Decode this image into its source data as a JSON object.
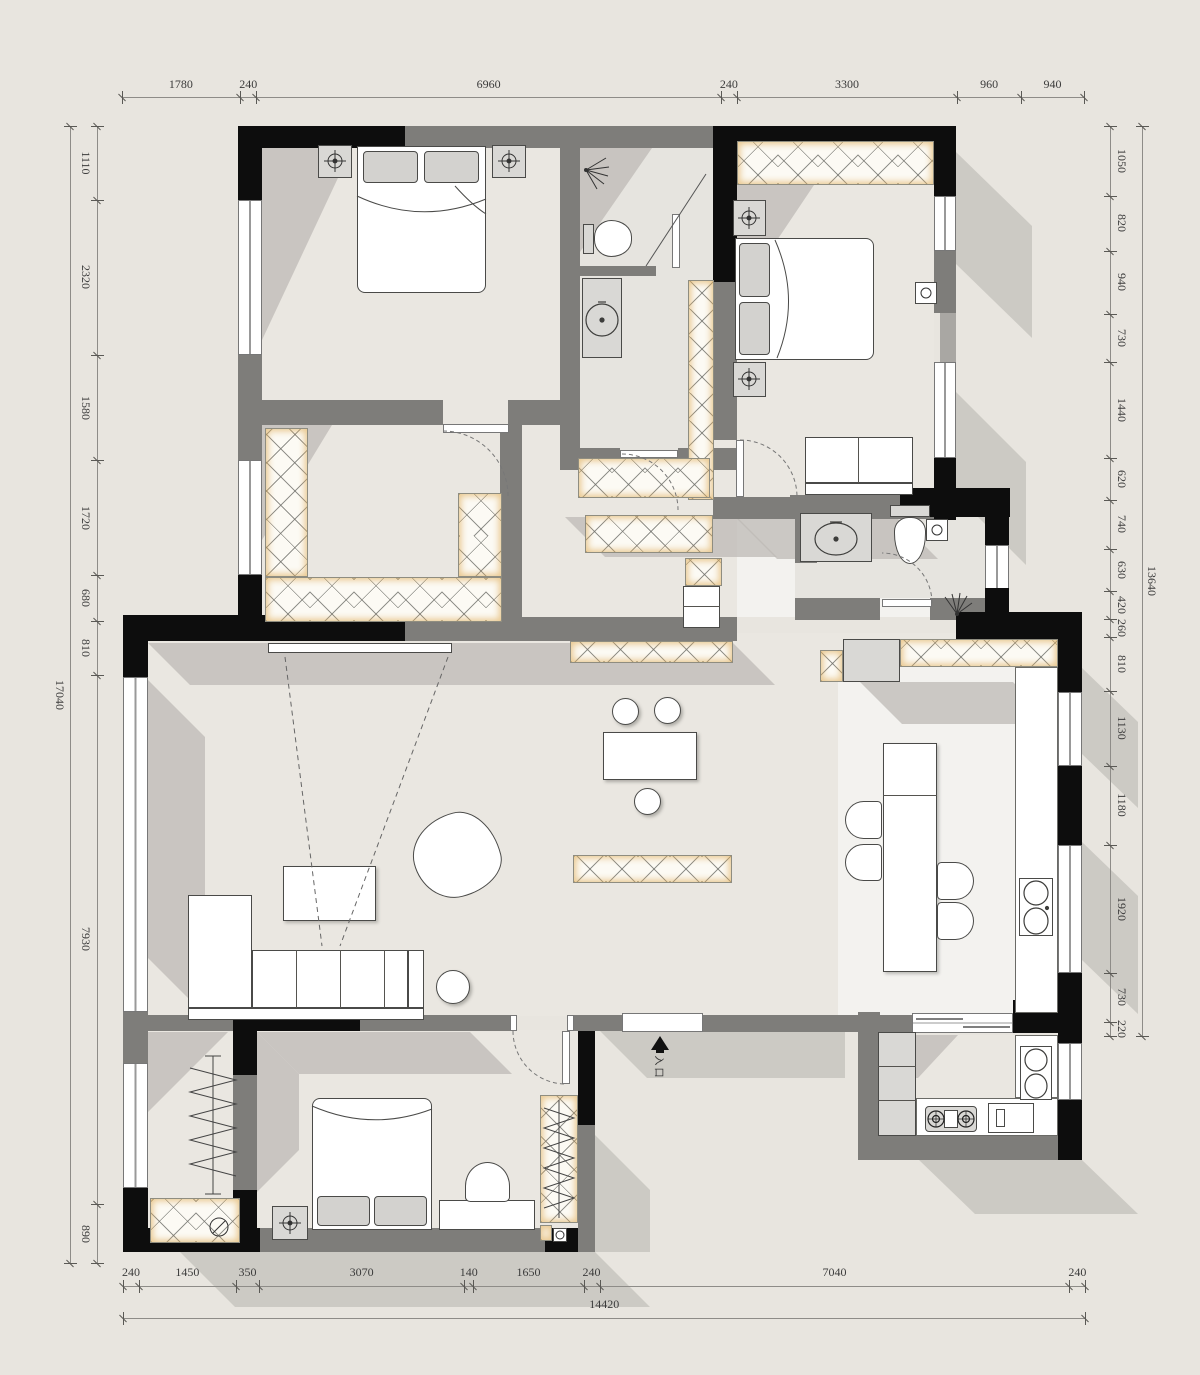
{
  "title": "apartment-floor-plan",
  "labels": {
    "entry": "入口"
  },
  "dims": {
    "top": [
      1780,
      240,
      6960,
      240,
      3300,
      960,
      940
    ],
    "bottom": [
      240,
      1450,
      350,
      3070,
      140,
      1650,
      240,
      7040,
      240
    ],
    "bottom_total": 14420,
    "left": [
      1110,
      2320,
      1580,
      1720,
      680,
      810,
      7930,
      890
    ],
    "left_total": 17040,
    "right": [
      1050,
      820,
      940,
      730,
      1440,
      620,
      740,
      630,
      420,
      260,
      810,
      1130,
      1180,
      1920,
      730,
      220
    ],
    "right_total": 13640
  },
  "colors": {
    "background": "#e8e5df",
    "wall_structural": "#0d0d0d",
    "wall_partition": "#7e7d7a",
    "floor": "#eae7e1",
    "cabinet_glow": "#deac58",
    "shadow": "#bdbab5",
    "dimension_text": "#3b3b3b"
  },
  "symbols": {
    "ceiling_lamp": "crosshair-circle",
    "shower_head": "spray-fan",
    "clothes_rail": "zigzag",
    "entry_arrow": "solid-triangle-up",
    "door_swing": "dashed-quarter-arc"
  }
}
